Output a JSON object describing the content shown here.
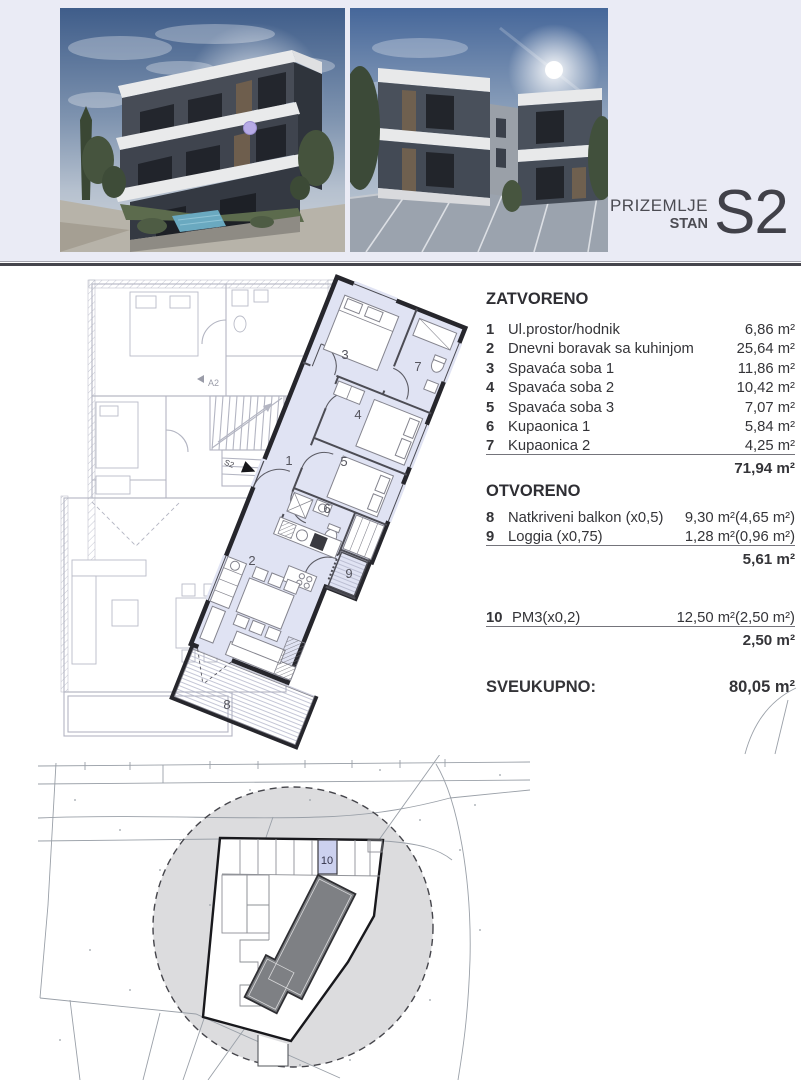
{
  "header": {
    "floor_label": "PRIZEMLJE",
    "type_label": "STAN",
    "unit_code": "S2"
  },
  "schedule": {
    "closed_title": "ZATVORENO",
    "closed_rows": [
      {
        "num": "1",
        "label": "Ul.prostor/hodnik",
        "value": "6,86 m²"
      },
      {
        "num": "2",
        "label": "Dnevni boravak sa kuhinjom",
        "value": "25,64 m²"
      },
      {
        "num": "3",
        "label": "Spavaća soba 1",
        "value": "11,86 m²"
      },
      {
        "num": "4",
        "label": "Spavaća soba 2",
        "value": "10,42 m²"
      },
      {
        "num": "5",
        "label": "Spavaća soba 3",
        "value": "7,07 m²"
      },
      {
        "num": "6",
        "label": "Kupaonica 1",
        "value": "5,84 m²"
      },
      {
        "num": "7",
        "label": "Kupaonica 2",
        "value": "4,25 m²"
      }
    ],
    "closed_total": "71,94 m²",
    "open_title": "OTVORENO",
    "open_rows": [
      {
        "num": "8",
        "label": "Natkriveni balkon (x0,5)",
        "value": "9,30 m²(4,65 m²)"
      },
      {
        "num": "9",
        "label": "Loggia (x0,75)",
        "value": "1,28 m²(0,96 m²)"
      }
    ],
    "open_total": "5,61 m²",
    "parking_rows": [
      {
        "num": "10",
        "label": "PM3(x0,2)",
        "value": "12,50 m²(2,50 m²)"
      }
    ],
    "parking_total": "2,50 m²",
    "grand_label": "SVEUKUPNO:",
    "grand_value": "80,05 m²"
  },
  "floor_plan": {
    "room_labels": [
      "1",
      "2",
      "3",
      "4",
      "5",
      "6",
      "7",
      "8",
      "9"
    ],
    "neighbor_label": "A2",
    "entrance_label": "S2"
  },
  "site_plan": {
    "parking_spot_label": "10"
  },
  "colors": {
    "top_band_bg": "#eaebf5",
    "unit_highlight": "#e0e3f3",
    "unit_wall": "#26262c",
    "parking_highlight": "#ccd1ef",
    "site_circle": "#dcdcde",
    "building_footprint": "#7e8084",
    "unit_marker_dot": "#b7abe6",
    "separator": "#45454d"
  }
}
